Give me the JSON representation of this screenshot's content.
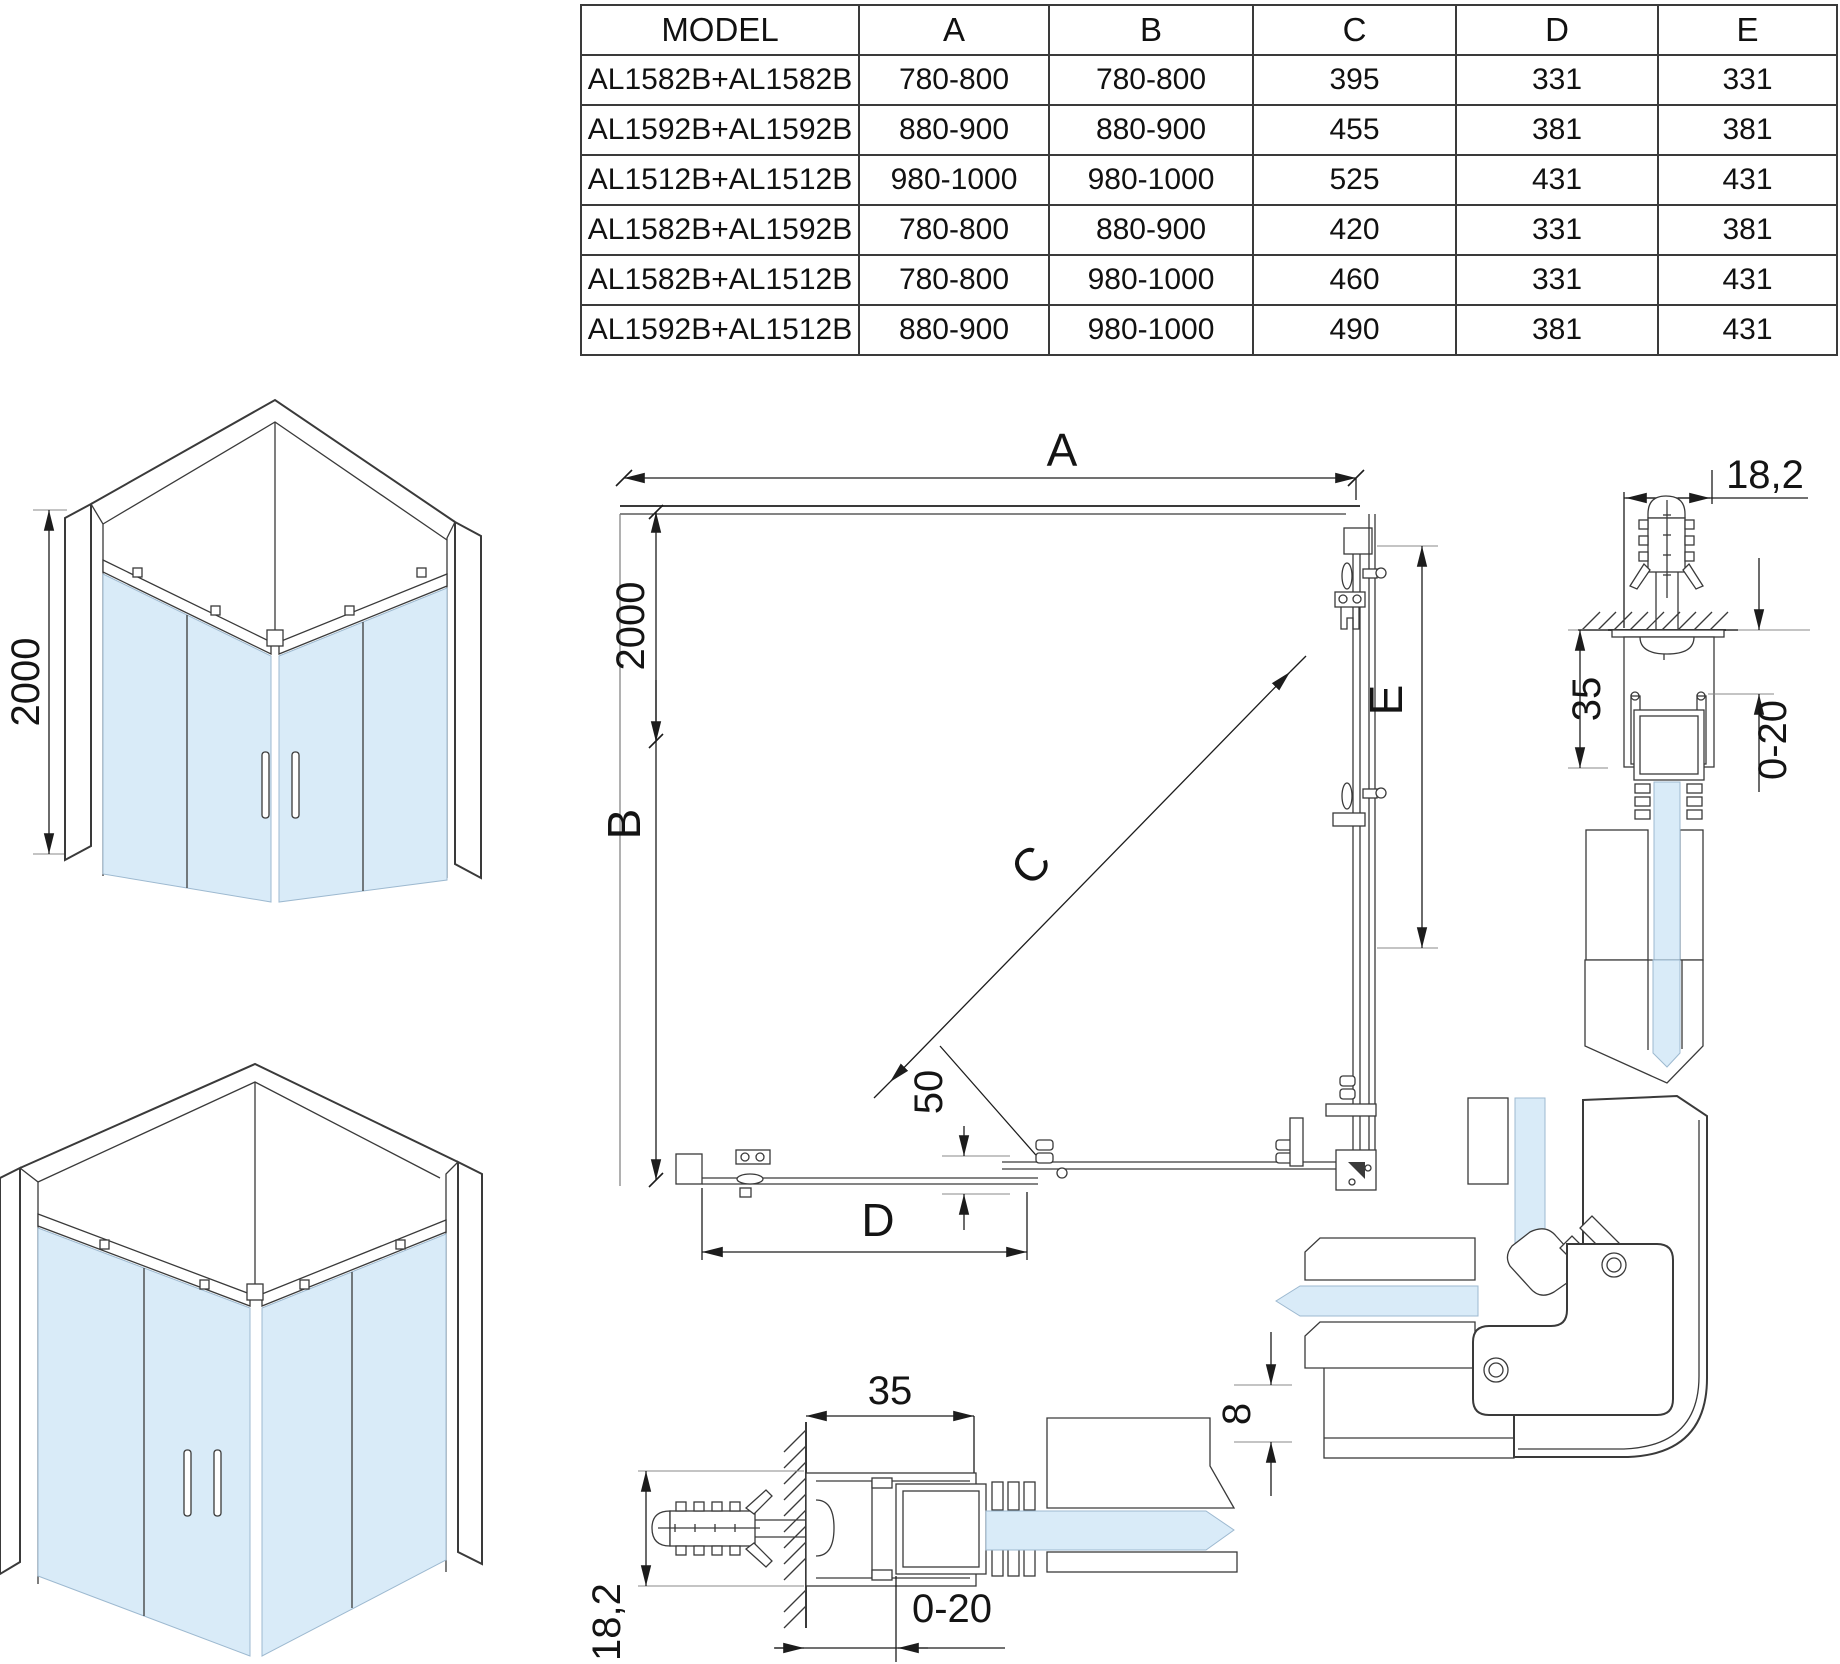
{
  "table": {
    "headers": [
      "MODEL",
      "A",
      "B",
      "C",
      "D",
      "E"
    ],
    "rows": [
      {
        "model": "AL1582B+AL1582B",
        "a": "780-800",
        "b": "780-800",
        "c": "395",
        "d": "331",
        "e": "331"
      },
      {
        "model": "AL1592B+AL1592B",
        "a": "880-900",
        "b": "880-900",
        "c": "455",
        "d": "381",
        "e": "381"
      },
      {
        "model": "AL1512B+AL1512B",
        "a": "980-1000",
        "b": "980-1000",
        "c": "525",
        "d": "431",
        "e": "431"
      },
      {
        "model": "AL1582B+AL1592B",
        "a": "780-800",
        "b": "880-900",
        "c": "420",
        "d": "331",
        "e": "381"
      },
      {
        "model": "AL1582B+AL1512B",
        "a": "780-800",
        "b": "980-1000",
        "c": "460",
        "d": "331",
        "e": "431"
      },
      {
        "model": "AL1592B+AL1512B",
        "a": "880-900",
        "b": "980-1000",
        "c": "490",
        "d": "381",
        "e": "431"
      }
    ]
  },
  "dimensions": {
    "width_a": "A",
    "depth_b": "B",
    "diag_c": "C",
    "fixed_d": "D",
    "fixed_e": "E",
    "height": "2000",
    "overlap": "50",
    "plug": "18,2",
    "profile": "35",
    "adjust": "0-20",
    "glass": "8"
  },
  "colors": {
    "glass": "#d9ebf8",
    "line": "#3a3a3a"
  }
}
